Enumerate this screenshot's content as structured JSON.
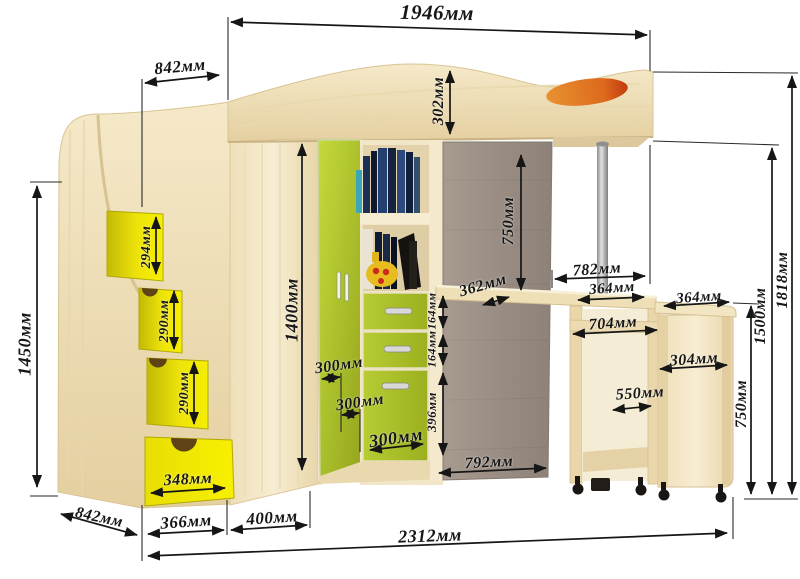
{
  "diagram": {
    "kind": "loft-bed furniture dimension drawing",
    "units": "мм"
  },
  "colors": {
    "wood_light": "#f3e7c6",
    "wood_mid": "#e7d4a8",
    "drawer_yellow": "#f0e607",
    "door_green": "#aabf2e",
    "back_panel_taupe": "#9c9085",
    "pillow_orange": "#d96b22",
    "dimension_ink": "#161616"
  },
  "dims": {
    "d1946": "1946мм",
    "d842_top": "842мм",
    "d302": "302мм",
    "d1450": "1450мм",
    "d294": "294мм",
    "d290_a": "290мм",
    "d290_b": "290мм",
    "d348": "348мм",
    "d1400": "1400мм",
    "d300_a": "300мм",
    "d300_b": "300мм",
    "d300_c": "300мм",
    "d164_a": "164мм",
    "d164_b": "164мм",
    "d396": "396мм",
    "d362": "362мм",
    "d750_under": "750мм",
    "d782": "782мм",
    "d364_a": "364мм",
    "d364_b": "364мм",
    "d704": "704мм",
    "d304": "304мм",
    "d550": "550мм",
    "d792": "792мм",
    "d842_bottom": "842мм",
    "d366": "366мм",
    "d400": "400мм",
    "d2312": "2312мм",
    "d750_right": "750мм",
    "d1500": "1500мм",
    "d1818": "1818мм"
  }
}
